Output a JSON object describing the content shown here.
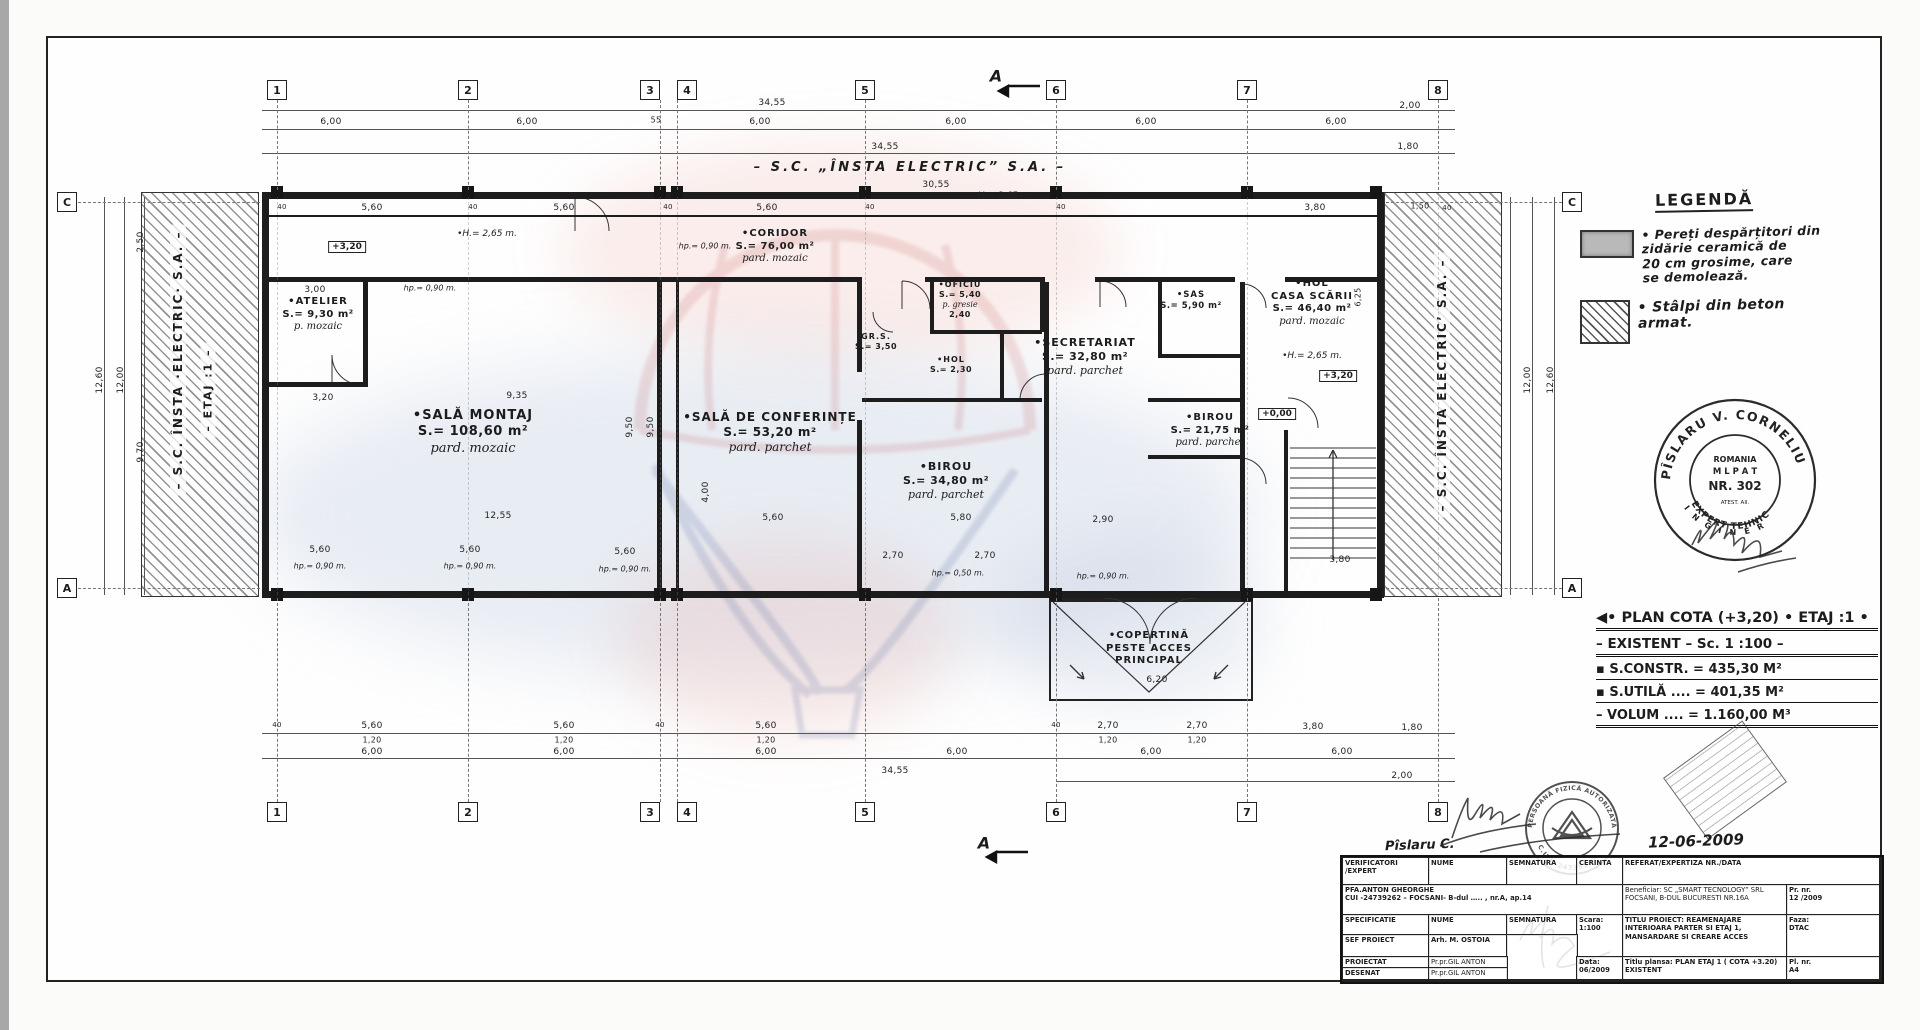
{
  "top_text": "– S.C. „ÎNSTA  ELECTRIC” S.A. –",
  "left_strip": {
    "line1": "– S.C. ÎNSTA ·ELECTRIC· S.A. –",
    "line2": "– ETAJ :1 –"
  },
  "right_strip": {
    "line1": "– S.C. ÎNSTA ELECTRIC’ S.A. –"
  },
  "section_marker": "A",
  "axes": {
    "cols": [
      {
        "n": "1",
        "x": 277
      },
      {
        "n": "2",
        "x": 468
      },
      {
        "n": "3",
        "x": 660,
        "bx": 650
      },
      {
        "n": "4",
        "x": 677,
        "bx": 687
      },
      {
        "n": "5",
        "x": 865
      },
      {
        "n": "6",
        "x": 1056
      },
      {
        "n": "7",
        "x": 1247
      },
      {
        "n": "8",
        "x": 1438
      }
    ],
    "letters": [
      {
        "l": "C",
        "x": 67,
        "y": 202
      },
      {
        "l": "A",
        "x": 67,
        "y": 588
      },
      {
        "l": "C",
        "x": 1572,
        "y": 202
      },
      {
        "l": "A",
        "x": 1572,
        "y": 588
      }
    ]
  },
  "rooms": [
    {
      "name": "•ATELIER",
      "area": "S.= 9,30 m²",
      "floor": "p. mozaic",
      "x": 318,
      "y": 296,
      "fs": 10
    },
    {
      "name": "•SALĂ  MONTAJ",
      "area": "S.= 108,60 m²",
      "floor": "pard. mozaic",
      "x": 473,
      "y": 408,
      "fs": 13
    },
    {
      "name": "•SALĂ DE CONFERINȚE",
      "area": "S.= 53,20 m²",
      "floor": "pard. parchet",
      "x": 770,
      "y": 410,
      "fs": 12
    },
    {
      "name": "•CORIDOR",
      "area": "S.= 76,00 m²",
      "floor": "pard. mozaic",
      "x": 775,
      "y": 228,
      "fs": 10
    },
    {
      "name": "•OFICIU",
      "area": "S.= 5,40",
      "floor": "p. gresie",
      "extra": "2,40",
      "x": 960,
      "y": 280,
      "fs": 8
    },
    {
      "name": "GR.S.",
      "area": "S.= 3,50",
      "x": 876,
      "y": 332,
      "fs": 8
    },
    {
      "name": "•HOL",
      "area": "S.= 2,30",
      "x": 951,
      "y": 355,
      "fs": 8
    },
    {
      "name": "•SECRETARIAT",
      "area": "S.= 32,80 m²",
      "floor": "pard. parchet",
      "x": 1085,
      "y": 336,
      "fs": 11
    },
    {
      "name": "•BIROU",
      "area": "S.= 34,80 m²",
      "floor": "pard. parchet",
      "x": 946,
      "y": 460,
      "fs": 11
    },
    {
      "name": "•SAS",
      "area": "S.= 5,90 m²",
      "x": 1191,
      "y": 290,
      "fs": 8.5
    },
    {
      "name": "•HOL",
      "name2": "CASA SCĂRII",
      "area": "S.= 46,40 m²",
      "floor": "pard. mozaic",
      "x": 1312,
      "y": 278,
      "fs": 10
    },
    {
      "name": "•BIROU",
      "area": "S.= 21,75 m²",
      "floor": "pard. parchet",
      "x": 1210,
      "y": 412,
      "fs": 10
    }
  ],
  "copertina": {
    "l1": "•COPERTINĂ",
    "l2": "PESTE ACCES",
    "l3": "PRINCIPAL"
  },
  "levels": [
    {
      "t": "+3,20",
      "x": 347,
      "y": 247
    },
    {
      "t": "+3,20",
      "x": 1338,
      "y": 376
    },
    {
      "t": "+0,00",
      "x": 1277,
      "y": 414
    }
  ],
  "notes": [
    {
      "t": "•H.= 2,65 m.",
      "x": 487,
      "y": 234,
      "fs": 9
    },
    {
      "t": "H.= 2,65 m.",
      "x": 1005,
      "y": 196,
      "fs": 9
    },
    {
      "t": "•H.= 2,65 m.",
      "x": 1312,
      "y": 356,
      "fs": 9
    },
    {
      "t": "hp.= 0,90 m.",
      "x": 430,
      "y": 288
    },
    {
      "t": "hp.= 0,90 m.",
      "x": 705,
      "y": 246
    },
    {
      "t": "hp.= 0,90 m.",
      "x": 320,
      "y": 566
    },
    {
      "t": "hp.= 0,90 m.",
      "x": 470,
      "y": 566
    },
    {
      "t": "hp.= 0,90 m.",
      "x": 625,
      "y": 569
    },
    {
      "t": "hp.= 0,50 m.",
      "x": 958,
      "y": 573
    },
    {
      "t": "hp.= 0,90 m.",
      "x": 1103,
      "y": 576
    }
  ],
  "dims": [
    {
      "t": "34,55",
      "x": 772,
      "y": 103
    },
    {
      "t": "6,00",
      "x": 331,
      "y": 122
    },
    {
      "t": "6,00",
      "x": 527,
      "y": 122
    },
    {
      "t": "55",
      "x": 656,
      "y": 120,
      "fs": 8
    },
    {
      "t": "6,00",
      "x": 760,
      "y": 122
    },
    {
      "t": "6,00",
      "x": 956,
      "y": 122
    },
    {
      "t": "6,00",
      "x": 1146,
      "y": 122
    },
    {
      "t": "6,00",
      "x": 1336,
      "y": 122
    },
    {
      "t": "2,00",
      "x": 1410,
      "y": 106
    },
    {
      "t": "34,55",
      "x": 885,
      "y": 147
    },
    {
      "t": "1,80",
      "x": 1408,
      "y": 147
    },
    {
      "t": "30,55",
      "x": 936,
      "y": 185
    },
    {
      "t": "5,60",
      "x": 372,
      "y": 208
    },
    {
      "t": "5,60",
      "x": 564,
      "y": 208
    },
    {
      "t": "5,60",
      "x": 767,
      "y": 208
    },
    {
      "t": "40",
      "x": 282,
      "y": 207,
      "fs": 7
    },
    {
      "t": "40",
      "x": 473,
      "y": 207,
      "fs": 7
    },
    {
      "t": "40",
      "x": 668,
      "y": 207,
      "fs": 7
    },
    {
      "t": "40",
      "x": 870,
      "y": 207,
      "fs": 7
    },
    {
      "t": "40",
      "x": 1061,
      "y": 207,
      "fs": 7
    },
    {
      "t": "3,80",
      "x": 1315,
      "y": 208
    },
    {
      "t": "1,50",
      "x": 1420,
      "y": 206,
      "fs": 8
    },
    {
      "t": "40",
      "x": 1447,
      "y": 208,
      "fs": 7
    },
    {
      "t": "12,60",
      "x": 100,
      "y": 380,
      "r": 1
    },
    {
      "t": "12,00",
      "x": 121,
      "y": 380,
      "r": 1
    },
    {
      "t": "2,50",
      "x": 141,
      "y": 242,
      "r": 1
    },
    {
      "t": "9,70",
      "x": 141,
      "y": 452,
      "r": 1
    },
    {
      "t": "12,00",
      "x": 1528,
      "y": 380,
      "r": 1
    },
    {
      "t": "12,60",
      "x": 1551,
      "y": 380,
      "r": 1
    },
    {
      "t": "6,25",
      "x": 1358,
      "y": 297,
      "r": 1,
      "fs": 8
    },
    {
      "t": "3,00",
      "x": 315,
      "y": 290
    },
    {
      "t": "3,20",
      "x": 323,
      "y": 398
    },
    {
      "t": "9,35",
      "x": 517,
      "y": 396
    },
    {
      "t": "12,55",
      "x": 498,
      "y": 516
    },
    {
      "t": "9,50",
      "x": 630,
      "y": 427,
      "r": 1
    },
    {
      "t": "9,50",
      "x": 651,
      "y": 427,
      "r": 1
    },
    {
      "t": "4,00",
      "x": 706,
      "y": 492,
      "r": 1
    },
    {
      "t": "5,60",
      "x": 773,
      "y": 518
    },
    {
      "t": "5,80",
      "x": 961,
      "y": 518
    },
    {
      "t": "2,90",
      "x": 1103,
      "y": 520
    },
    {
      "t": "3,80",
      "x": 1340,
      "y": 560
    },
    {
      "t": "5,60",
      "x": 320,
      "y": 550
    },
    {
      "t": "5,60",
      "x": 470,
      "y": 550
    },
    {
      "t": "5,60",
      "x": 625,
      "y": 552
    },
    {
      "t": "2,70",
      "x": 893,
      "y": 556
    },
    {
      "t": "2,70",
      "x": 985,
      "y": 556
    },
    {
      "t": "6,20",
      "x": 1157,
      "y": 680
    },
    {
      "t": "5,60",
      "x": 372,
      "y": 726
    },
    {
      "t": "5,60",
      "x": 564,
      "y": 726
    },
    {
      "t": "5,60",
      "x": 766,
      "y": 726
    },
    {
      "t": "1,20",
      "x": 372,
      "y": 740,
      "fs": 8
    },
    {
      "t": "1,20",
      "x": 564,
      "y": 740,
      "fs": 8
    },
    {
      "t": "1,20",
      "x": 766,
      "y": 740,
      "fs": 8
    },
    {
      "t": "2,70",
      "x": 1108,
      "y": 726
    },
    {
      "t": "2,70",
      "x": 1197,
      "y": 726
    },
    {
      "t": "1,20",
      "x": 1108,
      "y": 740,
      "fs": 8
    },
    {
      "t": "1,20",
      "x": 1197,
      "y": 740,
      "fs": 8
    },
    {
      "t": "3,80",
      "x": 1313,
      "y": 727
    },
    {
      "t": "1,80",
      "x": 1412,
      "y": 728
    },
    {
      "t": "6,00",
      "x": 372,
      "y": 752
    },
    {
      "t": "6,00",
      "x": 564,
      "y": 752
    },
    {
      "t": "6,00",
      "x": 766,
      "y": 752
    },
    {
      "t": "6,00",
      "x": 957,
      "y": 752
    },
    {
      "t": "6,00",
      "x": 1151,
      "y": 752
    },
    {
      "t": "6,00",
      "x": 1342,
      "y": 752
    },
    {
      "t": "34,55",
      "x": 895,
      "y": 771
    },
    {
      "t": "2,00",
      "x": 1402,
      "y": 776
    },
    {
      "t": "40",
      "x": 277,
      "y": 725,
      "fs": 7
    },
    {
      "t": "40",
      "x": 660,
      "y": 725,
      "fs": 7
    },
    {
      "t": "40",
      "x": 1056,
      "y": 725,
      "fs": 7
    }
  ],
  "legend": {
    "title": "LEGENDĂ",
    "item1": "Pereți despărțitori din\nzidărie ceramică de\n20 cm grosime, care\nse demolează.",
    "item2": "Stâlpi din beton\narmat."
  },
  "expert_stamp": {
    "arc_top": "PÎSLARU V. CORNELIU",
    "inner1": "ROMANIA",
    "inner2": "M L P A T",
    "inner3": "NR. 302",
    "inner4": "ATEST. AII.",
    "arc_bottom1": "I N G I N E R",
    "arc_bottom2": "EXPERT TEHNIC"
  },
  "pfa_stamp": {
    "arc_top": "PERSOANĂ FIZICĂ AUTORIZATĂ",
    "arc_bottom": "C.U.I. 24739262"
  },
  "plan_title": {
    "l1": "• PLAN COTA (+3,20) • ETAJ :1 •",
    "l2": "– EXISTENT – Sc. 1 :100 –",
    "l3": "▪ S.CONSTR.    = 435,30 M²",
    "l4": "▪ S.UTILĂ ....    = 401,35 M²",
    "l5": "– VOLUM ....   = 1.160,00 M³"
  },
  "handwriting": {
    "name": "Pîslaru C.",
    "date": "12-06-2009"
  },
  "titleblock": {
    "cells": [
      "VERIFICATORI\n/EXPERT",
      "NUME",
      "SEMNATURA",
      "CERINTA",
      "REFERAT/EXPERTIZA NR./DATA",
      "PFA.ANTON GHEORGHE\nCUI -24739262 – FOCSANI- B-dul ….. , nr.A, ap.14",
      "Beneficiar:  SC „SMART TECNOLOGY” SRL\nFOCSANI, B-DUL BUCURESTI NR.16A",
      "Pr. nr.\n12 /2009",
      "SPECIFICATIE",
      "NUME",
      "SEMNATURA",
      "Scara:\n1:100",
      "TITLU PROIECT: REAMENAJARE\nINTERIOARA PARTER SI ETAJ 1,\nMANSARDARE SI CREARE ACCES",
      "Faza:\nDTAC",
      "SEF PROIECT",
      "Arh. M. OSTOIA",
      "",
      "PROIECTAT",
      "Pr.pr.GIL ANTON",
      "Data:\n06/2009",
      "Titlu plansa:  PLAN ETAJ 1 ( COTA +3.20)\nEXISTENT",
      "Pl. nr.\nA4",
      "DESENAT",
      "Pr.pr.GIL ANTON"
    ]
  }
}
